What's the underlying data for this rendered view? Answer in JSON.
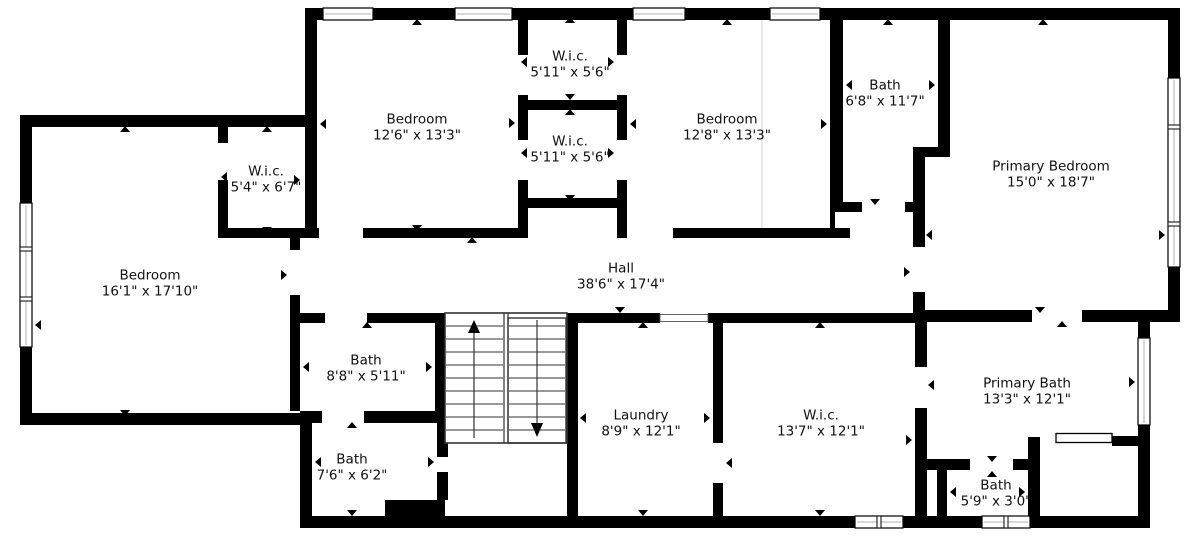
{
  "title": "Floor plan",
  "colors": {
    "wall": "#000000",
    "background": "#ffffff",
    "text": "#111111",
    "stair_line": "#333333"
  },
  "rooms": [
    {
      "id": "wic-top",
      "name": "W.i.c.",
      "size": "5'11\" x 5'6\""
    },
    {
      "id": "bedroom-front",
      "name": "Bedroom",
      "size": "12'6\" x 13'3\""
    },
    {
      "id": "wic-mid",
      "name": "W.i.c.",
      "size": "5'11\" x 5'6\""
    },
    {
      "id": "bedroom-middle",
      "name": "Bedroom",
      "size": "12'8\" x 13'3\""
    },
    {
      "id": "bath-upper",
      "name": "Bath",
      "size": "6'8\" x 11'7\""
    },
    {
      "id": "primary-bedroom",
      "name": "Primary Bedroom",
      "size": "15'0\" x 18'7\""
    },
    {
      "id": "wic-left",
      "name": "W.i.c.",
      "size": "5'4\" x 6'7\""
    },
    {
      "id": "bedroom-left",
      "name": "Bedroom",
      "size": "16'1\" x 17'10\""
    },
    {
      "id": "hall",
      "name": "Hall",
      "size": "38'6\" x 17'4\""
    },
    {
      "id": "bath-mid",
      "name": "Bath",
      "size": "8'8\" x 5'11\""
    },
    {
      "id": "bath-lower",
      "name": "Bath",
      "size": "7'6\" x 6'2\""
    },
    {
      "id": "laundry",
      "name": "Laundry",
      "size": "8'9\" x 12'1\""
    },
    {
      "id": "wic-big",
      "name": "W.i.c.",
      "size": "13'7\" x 12'1\""
    },
    {
      "id": "primary-bath",
      "name": "Primary Bath",
      "size": "13'3\" x 12'1\""
    },
    {
      "id": "bath-small",
      "name": "Bath",
      "size": "5'9\" x 3'0\""
    }
  ]
}
